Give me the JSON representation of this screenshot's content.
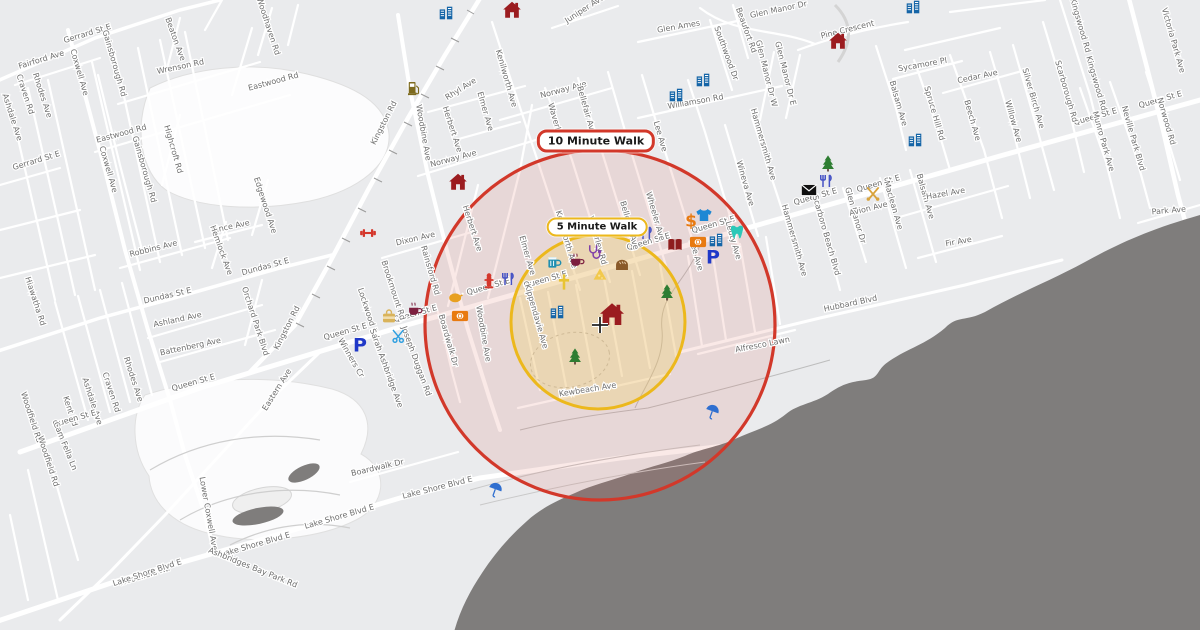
{
  "map": {
    "annotations": {
      "ten_minute_label": "10 Minute Walk",
      "five_minute_label": "5 Minute Walk"
    },
    "colors": {
      "land": "#eaebed",
      "road": "#ffffff",
      "water": "#7f7d7c",
      "ten_circle_stroke": "#d2382a",
      "ten_circle_fill": "rgba(214,88,70,0.13)",
      "five_circle_stroke": "#ecb81c",
      "five_circle_fill": "rgba(240,212,105,0.32)"
    },
    "circles": {
      "ten": {
        "cx": 600,
        "cy": 325,
        "r": 175,
        "label_x": 596,
        "label_y": 141
      },
      "five": {
        "cx": 598,
        "cy": 322,
        "r": 87,
        "label_x": 597,
        "label_y": 227
      }
    },
    "home": {
      "x": 612,
      "y": 316
    },
    "crosshair": {
      "x": 600,
      "y": 325
    },
    "street_labels": [
      {
        "t": "Gerrard St E",
        "x": 88,
        "y": 36,
        "a": -17
      },
      {
        "t": "Fairford Ave",
        "x": 42,
        "y": 62,
        "a": -17
      },
      {
        "t": "Gerrard St E",
        "x": 37,
        "y": 163,
        "a": -17
      },
      {
        "t": "Coxwell Ave",
        "x": 77,
        "y": 73,
        "a": 74
      },
      {
        "t": "Coxwell Ave",
        "x": 106,
        "y": 170,
        "a": 74
      },
      {
        "t": "Rhodes Ave",
        "x": 40,
        "y": 96,
        "a": 72
      },
      {
        "t": "Rhodes Ave",
        "x": 131,
        "y": 380,
        "a": 72
      },
      {
        "t": "Craven Rd",
        "x": 23,
        "y": 95,
        "a": 72
      },
      {
        "t": "Craven Rd",
        "x": 109,
        "y": 393,
        "a": 72
      },
      {
        "t": "Ashdale Ave",
        "x": 10,
        "y": 118,
        "a": 72
      },
      {
        "t": "Ashdale Ave",
        "x": 90,
        "y": 402,
        "a": 72
      },
      {
        "t": "Kent Rd",
        "x": 68,
        "y": 412,
        "a": 72
      },
      {
        "t": "Woodfield Rd",
        "x": 29,
        "y": 418,
        "a": 72
      },
      {
        "t": "Woodfield Rd",
        "x": 46,
        "y": 462,
        "a": 72
      },
      {
        "t": "Woodfield Rd",
        "x": 145,
        "y": 578,
        "a": -17
      },
      {
        "t": "Gainsborough Rd",
        "x": 112,
        "y": 64,
        "a": 74
      },
      {
        "t": "Gainsborough Rd",
        "x": 142,
        "y": 170,
        "a": 74
      },
      {
        "t": "Beaton Ave",
        "x": 173,
        "y": 40,
        "a": 70
      },
      {
        "t": "Wrenson Rd",
        "x": 181,
        "y": 69,
        "a": -12
      },
      {
        "t": "Eastwood Rd",
        "x": 122,
        "y": 136,
        "a": -15
      },
      {
        "t": "Eastwood Rd",
        "x": 274,
        "y": 84,
        "a": -15
      },
      {
        "t": "Highcroft Rd",
        "x": 171,
        "y": 150,
        "a": 74
      },
      {
        "t": "Woodhaven Rd",
        "x": 266,
        "y": 27,
        "a": 72
      },
      {
        "t": "Edgewood Ave",
        "x": 263,
        "y": 206,
        "a": 72
      },
      {
        "t": "Hiawatha Rd",
        "x": 33,
        "y": 302,
        "a": 72
      },
      {
        "t": "Dundas St E",
        "x": 168,
        "y": 298,
        "a": -13
      },
      {
        "t": "Dundas St E",
        "x": 266,
        "y": 269,
        "a": -15
      },
      {
        "t": "Robbins Ave",
        "x": 154,
        "y": 251,
        "a": -14
      },
      {
        "t": "Vince Ave",
        "x": 231,
        "y": 229,
        "a": -12
      },
      {
        "t": "Hemlock Ave",
        "x": 219,
        "y": 251,
        "a": 70
      },
      {
        "t": "Orchard Park Blvd",
        "x": 253,
        "y": 322,
        "a": 72
      },
      {
        "t": "Ashland Ave",
        "x": 178,
        "y": 322,
        "a": -12
      },
      {
        "t": "Battenberg Ave",
        "x": 191,
        "y": 349,
        "a": -12
      },
      {
        "t": "Queen St E",
        "x": 75,
        "y": 421,
        "a": -16
      },
      {
        "t": "Queen St E",
        "x": 194,
        "y": 385,
        "a": -16
      },
      {
        "t": "Queen St E",
        "x": 346,
        "y": 334,
        "a": -16
      },
      {
        "t": "Queen St E",
        "x": 416,
        "y": 316,
        "a": -16
      },
      {
        "t": "Queen St E",
        "x": 489,
        "y": 289,
        "a": -16
      },
      {
        "t": "Queen St E",
        "x": 546,
        "y": 282,
        "a": -16
      },
      {
        "t": "Queen St E",
        "x": 649,
        "y": 244,
        "a": -16
      },
      {
        "t": "Queen St E",
        "x": 714,
        "y": 227,
        "a": -16
      },
      {
        "t": "Queen St E",
        "x": 816,
        "y": 199,
        "a": -16
      },
      {
        "t": "Queen St E",
        "x": 879,
        "y": 186,
        "a": -16
      },
      {
        "t": "Queen St E",
        "x": 1096,
        "y": 119,
        "a": -16
      },
      {
        "t": "Queen St E",
        "x": 1161,
        "y": 102,
        "a": -16
      },
      {
        "t": "Kingston Rd",
        "x": 386,
        "y": 124,
        "a": -63
      },
      {
        "t": "Kingston Rd",
        "x": 289,
        "y": 329,
        "a": -63
      },
      {
        "t": "Eastern Ave",
        "x": 279,
        "y": 391,
        "a": -58
      },
      {
        "t": "Lower Coxwell Ave",
        "x": 206,
        "y": 514,
        "a": 80
      },
      {
        "t": "Cam Fella Ln",
        "x": 63,
        "y": 447,
        "a": 68
      },
      {
        "t": "Lake Shore Blvd E",
        "x": 148,
        "y": 575,
        "a": -18
      },
      {
        "t": "Lake Shore Blvd E",
        "x": 256,
        "y": 547,
        "a": -16
      },
      {
        "t": "Lake Shore Blvd E",
        "x": 340,
        "y": 519,
        "a": -16
      },
      {
        "t": "Lake Shore Blvd E",
        "x": 438,
        "y": 490,
        "a": -14
      },
      {
        "t": "Ashbridges Bay Park Rd",
        "x": 252,
        "y": 570,
        "a": 22
      },
      {
        "t": "Boardwalk Dr",
        "x": 378,
        "y": 470,
        "a": -13
      },
      {
        "t": "Boardwalk Dr",
        "x": 446,
        "y": 341,
        "a": 74
      },
      {
        "t": "Woodbine Ave",
        "x": 421,
        "y": 133,
        "a": 80
      },
      {
        "t": "Woodbine Ave",
        "x": 481,
        "y": 334,
        "a": 80
      },
      {
        "t": "Norway Ave",
        "x": 454,
        "y": 161,
        "a": -15
      },
      {
        "t": "Norway Ave",
        "x": 564,
        "y": 92,
        "a": -15
      },
      {
        "t": "Rhyl Ave",
        "x": 462,
        "y": 91,
        "a": -32
      },
      {
        "t": "Herbert Ave",
        "x": 450,
        "y": 130,
        "a": 72
      },
      {
        "t": "Herbert Ave",
        "x": 470,
        "y": 229,
        "a": 72
      },
      {
        "t": "Elmer Ave",
        "x": 483,
        "y": 112,
        "a": 74
      },
      {
        "t": "Elmer Ave",
        "x": 525,
        "y": 256,
        "a": 74
      },
      {
        "t": "Kenilworth Ave",
        "x": 504,
        "y": 79,
        "a": 74
      },
      {
        "t": "Kenilworth Ave",
        "x": 564,
        "y": 240,
        "a": 74
      },
      {
        "t": "Waverley Rd",
        "x": 555,
        "y": 128,
        "a": 74
      },
      {
        "t": "Waverley Rd",
        "x": 595,
        "y": 241,
        "a": 74
      },
      {
        "t": "Bellefair Ave",
        "x": 584,
        "y": 111,
        "a": 74
      },
      {
        "t": "Bellefair Ave",
        "x": 627,
        "y": 226,
        "a": 74
      },
      {
        "t": "Wheeler Ave",
        "x": 653,
        "y": 217,
        "a": 74
      },
      {
        "t": "Lee Ave",
        "x": 658,
        "y": 137,
        "a": 74
      },
      {
        "t": "Lee Ave",
        "x": 694,
        "y": 256,
        "a": 74
      },
      {
        "t": "Leuty Ave",
        "x": 731,
        "y": 241,
        "a": 74
      },
      {
        "t": "Wineva Ave",
        "x": 743,
        "y": 184,
        "a": 74
      },
      {
        "t": "Hammersmith Ave",
        "x": 761,
        "y": 145,
        "a": 74
      },
      {
        "t": "Hammersmith Ave",
        "x": 792,
        "y": 241,
        "a": 74
      },
      {
        "t": "Scarboro Beach Blvd",
        "x": 824,
        "y": 236,
        "a": 74
      },
      {
        "t": "Glen Manor Dr",
        "x": 853,
        "y": 216,
        "a": 74
      },
      {
        "t": "Avion Ave",
        "x": 869,
        "y": 211,
        "a": -14
      },
      {
        "t": "Maclean Ave",
        "x": 891,
        "y": 206,
        "a": 74
      },
      {
        "t": "Balsam Ave",
        "x": 896,
        "y": 104,
        "a": 74
      },
      {
        "t": "Balsam Ave",
        "x": 923,
        "y": 197,
        "a": 74
      },
      {
        "t": "Hazel Ave",
        "x": 946,
        "y": 196,
        "a": -10
      },
      {
        "t": "Fir Ave",
        "x": 959,
        "y": 244,
        "a": -10
      },
      {
        "t": "Hubbard Blvd",
        "x": 851,
        "y": 306,
        "a": -12
      },
      {
        "t": "Alfresco Lawn",
        "x": 763,
        "y": 347,
        "a": -11
      },
      {
        "t": "Glen Manor Dr",
        "x": 779,
        "y": 12,
        "a": -12
      },
      {
        "t": "Glen Ames",
        "x": 679,
        "y": 29,
        "a": -10
      },
      {
        "t": "Beaufort Rd",
        "x": 744,
        "y": 31,
        "a": 70
      },
      {
        "t": "Southwood Dr",
        "x": 724,
        "y": 54,
        "a": 70
      },
      {
        "t": "Williamson Rd",
        "x": 696,
        "y": 104,
        "a": -10
      },
      {
        "t": "Glen Manor Dr W",
        "x": 764,
        "y": 74,
        "a": 76
      },
      {
        "t": "Glen Manor Dr E",
        "x": 783,
        "y": 74,
        "a": 76
      },
      {
        "t": "Pine Crescent",
        "x": 848,
        "y": 32,
        "a": -14
      },
      {
        "t": "Sycamore Pl",
        "x": 923,
        "y": 67,
        "a": -10
      },
      {
        "t": "Cedar Ave",
        "x": 978,
        "y": 79,
        "a": -12
      },
      {
        "t": "Willow Ave",
        "x": 1011,
        "y": 122,
        "a": 74
      },
      {
        "t": "Spruce Hill Rd",
        "x": 932,
        "y": 114,
        "a": 74
      },
      {
        "t": "Beech Ave",
        "x": 970,
        "y": 121,
        "a": 74
      },
      {
        "t": "Silver Birch Ave",
        "x": 1031,
        "y": 99,
        "a": 74
      },
      {
        "t": "Scarborough Rd",
        "x": 1064,
        "y": 92,
        "a": 74
      },
      {
        "t": "Kingswood Rd",
        "x": 1078,
        "y": 26,
        "a": 74
      },
      {
        "t": "Kingswood Rd",
        "x": 1094,
        "y": 84,
        "a": 74
      },
      {
        "t": "Victoria Park Ave",
        "x": 1171,
        "y": 41,
        "a": 74
      },
      {
        "t": "Norwood Rd",
        "x": 1164,
        "y": 122,
        "a": 74
      },
      {
        "t": "Neville Park Blvd",
        "x": 1131,
        "y": 139,
        "a": 74
      },
      {
        "t": "Munro Park Ave",
        "x": 1101,
        "y": 142,
        "a": 74
      },
      {
        "t": "Park Ave",
        "x": 1169,
        "y": 213,
        "a": -5
      },
      {
        "t": "Juniper Ave",
        "x": 586,
        "y": 11,
        "a": -33
      },
      {
        "t": "Kewbeach Ave",
        "x": 588,
        "y": 392,
        "a": -9
      },
      {
        "t": "Kippendavie Ave",
        "x": 534,
        "y": 317,
        "a": 74
      },
      {
        "t": "Dixon Ave",
        "x": 416,
        "y": 241,
        "a": -13
      },
      {
        "t": "Rainsford Rd",
        "x": 428,
        "y": 271,
        "a": 74
      },
      {
        "t": "Brookmount Rd",
        "x": 391,
        "y": 291,
        "a": 72
      },
      {
        "t": "Lockwood Rd",
        "x": 366,
        "y": 314,
        "a": 72
      },
      {
        "t": "Joseph Duggan Rd",
        "x": 414,
        "y": 362,
        "a": 70
      },
      {
        "t": "Sarah Ashbridge Ave",
        "x": 384,
        "y": 369,
        "a": 70
      },
      {
        "t": "Winners Cr",
        "x": 349,
        "y": 359,
        "a": 60
      }
    ],
    "pois": [
      {
        "k": "house",
        "x": 512,
        "y": 10
      },
      {
        "k": "house",
        "x": 838,
        "y": 41
      },
      {
        "k": "house",
        "x": 458,
        "y": 182
      },
      {
        "k": "school",
        "x": 446,
        "y": 13
      },
      {
        "k": "school",
        "x": 676,
        "y": 95
      },
      {
        "k": "school",
        "x": 703,
        "y": 80
      },
      {
        "k": "school",
        "x": 913,
        "y": 7
      },
      {
        "k": "school",
        "x": 915,
        "y": 140
      },
      {
        "k": "school",
        "x": 557,
        "y": 312
      },
      {
        "k": "school",
        "x": 716,
        "y": 240
      },
      {
        "k": "parking",
        "x": 713,
        "y": 258
      },
      {
        "k": "parking",
        "x": 360,
        "y": 346
      },
      {
        "k": "dollar",
        "x": 691,
        "y": 222
      },
      {
        "k": "tshirt",
        "x": 704,
        "y": 215
      },
      {
        "k": "money",
        "x": 698,
        "y": 242
      },
      {
        "k": "money",
        "x": 460,
        "y": 316
      },
      {
        "k": "tooth",
        "x": 737,
        "y": 232
      },
      {
        "k": "book",
        "x": 675,
        "y": 245
      },
      {
        "k": "utensils",
        "x": 646,
        "y": 233
      },
      {
        "k": "utensils",
        "x": 508,
        "y": 279
      },
      {
        "k": "utensils",
        "x": 826,
        "y": 181
      },
      {
        "k": "envelope",
        "x": 809,
        "y": 190
      },
      {
        "k": "golf",
        "x": 873,
        "y": 194
      },
      {
        "k": "tree",
        "x": 828,
        "y": 163
      },
      {
        "k": "tree",
        "x": 667,
        "y": 292
      },
      {
        "k": "tree",
        "x": 575,
        "y": 356
      },
      {
        "k": "umbrella",
        "x": 495,
        "y": 490
      },
      {
        "k": "umbrella",
        "x": 712,
        "y": 412
      },
      {
        "k": "fuel",
        "x": 414,
        "y": 88
      },
      {
        "k": "dumbbell",
        "x": 368,
        "y": 233
      },
      {
        "k": "hydrant",
        "x": 489,
        "y": 281
      },
      {
        "k": "coffee",
        "x": 577,
        "y": 260
      },
      {
        "k": "coffee",
        "x": 415,
        "y": 309
      },
      {
        "k": "beer",
        "x": 554,
        "y": 262
      },
      {
        "k": "stethoscope",
        "x": 594,
        "y": 252
      },
      {
        "k": "cross",
        "x": 564,
        "y": 282
      },
      {
        "k": "cheese",
        "x": 600,
        "y": 274
      },
      {
        "k": "bread",
        "x": 622,
        "y": 264
      },
      {
        "k": "chicken",
        "x": 456,
        "y": 297
      },
      {
        "k": "bag",
        "x": 389,
        "y": 316
      },
      {
        "k": "scissors",
        "x": 399,
        "y": 336
      }
    ]
  }
}
